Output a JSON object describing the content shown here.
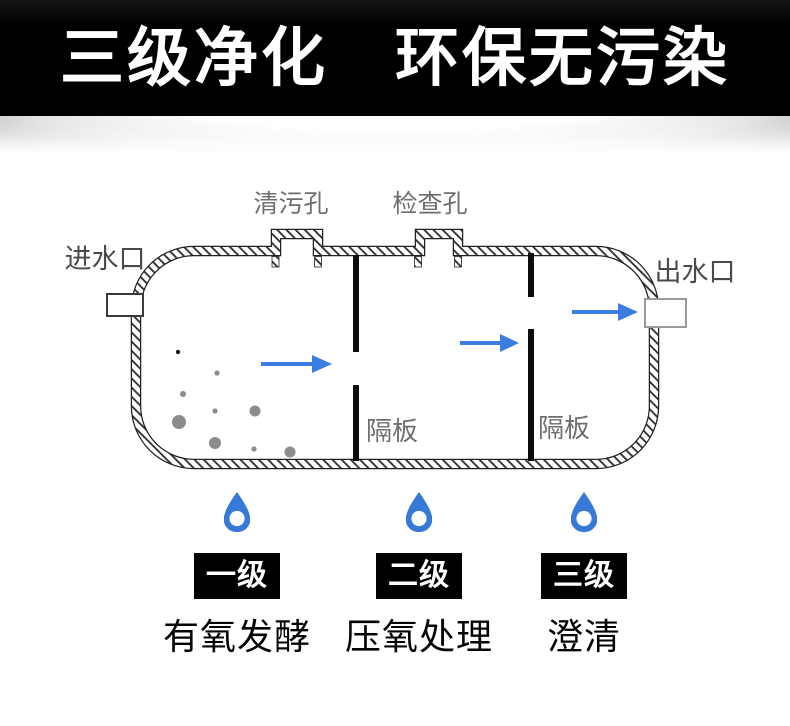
{
  "banner": {
    "title": "三级净化　环保无污染"
  },
  "tank": {
    "clean_hole_label": "清污孔",
    "inspection_hole_label": "检查孔",
    "inlet_label": "进水口",
    "outlet_label": "出水口",
    "baffle_label_1": "隔板",
    "baffle_label_2": "隔板"
  },
  "stages": [
    {
      "level": "一级",
      "process": "有氧发酵"
    },
    {
      "level": "二级",
      "process": "压氧处理"
    },
    {
      "level": "三级",
      "process": "澄清"
    }
  ],
  "icons": {
    "stage_marker": "water-drop-icon",
    "flow_marker": "flow-arrow-icon"
  },
  "colors": {
    "arrow_blue": "#3b7de2",
    "drop_blue": "#3679d6",
    "label_gray": "#6e6e6e",
    "io_label_gray": "#4a4a4a",
    "stage_box_bg": "#000000",
    "banner_bg": "#000000",
    "banner_text": "#ffffff"
  }
}
